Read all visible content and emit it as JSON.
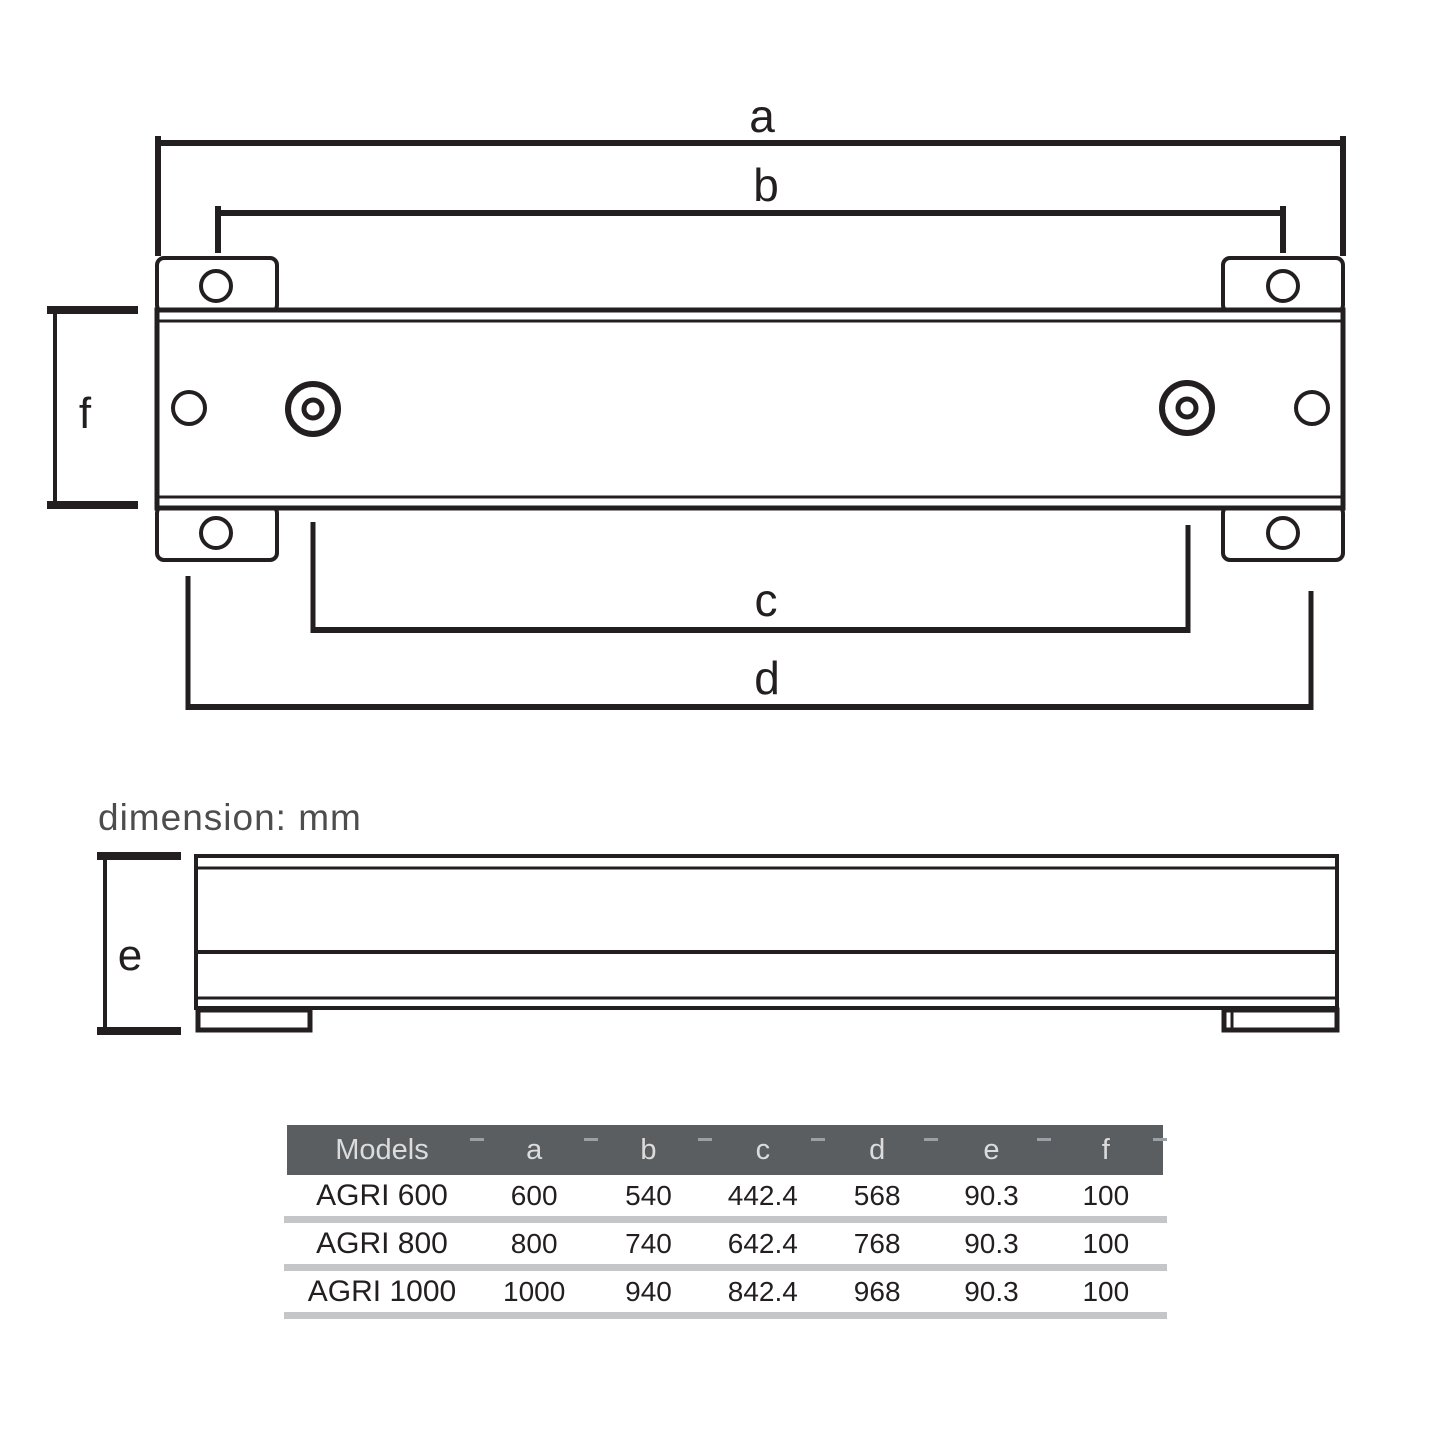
{
  "note": {
    "text": "dimension: mm"
  },
  "diagram": {
    "labels": {
      "a": "a",
      "b": "b",
      "c": "c",
      "d": "d",
      "e": "e",
      "f": "f"
    }
  },
  "table": {
    "headers": [
      "Models",
      "a",
      "b",
      "c",
      "d",
      "e",
      "f"
    ],
    "rows": [
      {
        "model": "AGRI 600",
        "a": "600",
        "b": "540",
        "c": "442.4",
        "d": "568",
        "e": "90.3",
        "f": "100"
      },
      {
        "model": "AGRI 800",
        "a": "800",
        "b": "740",
        "c": "642.4",
        "d": "768",
        "e": "90.3",
        "f": "100"
      },
      {
        "model": "AGRI 1000",
        "a": "1000",
        "b": "940",
        "c": "842.4",
        "d": "968",
        "e": "90.3",
        "f": "100"
      }
    ]
  },
  "colors": {
    "ink": "#231f20",
    "header_bg": "#5a5e61",
    "header_text": "#dcdcdc",
    "tick_color": "#9aa0a3",
    "separator": "#c4c6c7",
    "note_text": "#4d4d4d"
  }
}
